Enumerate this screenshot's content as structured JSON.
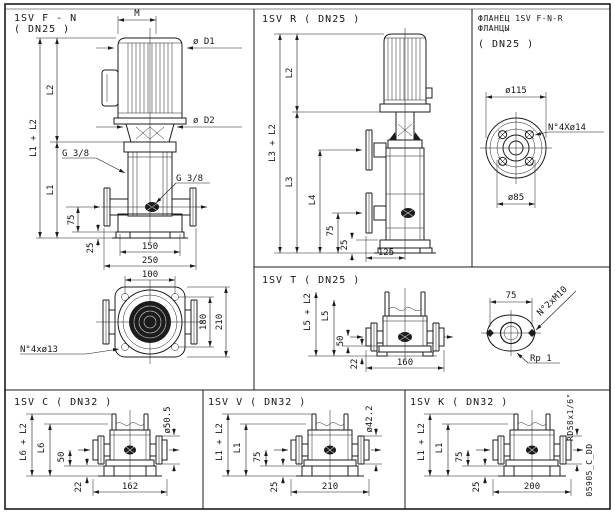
{
  "drawing_code": "05905_C_DD",
  "panels": {
    "fn": {
      "title1": "1SV F - N",
      "title2": "( DN25 )",
      "m": "M",
      "d1": "ø D1",
      "d2": "ø D2",
      "l2": "L2",
      "l1_l2": "L1 + L2",
      "l1": "L1",
      "g38_left": "G 3/8",
      "g38_right": "G 3/8",
      "d75": "75",
      "d25": "25",
      "d150": "150",
      "d250": "250",
      "bottom_view": {
        "d100": "100",
        "d180": "180",
        "d210": "210",
        "holes": "N°4xø13"
      }
    },
    "r": {
      "title": "1SV R ( DN25 )",
      "l2": "L2",
      "l3_l2": "L3 + L2",
      "l3": "L3",
      "l4": "L4",
      "d75": "75",
      "d25": "25",
      "d125": "125"
    },
    "flange_fnr": {
      "line1": "ФЛАНЕЦ 1SV F-N-R",
      "line2": "ФЛАНЦЫ",
      "line3": "( DN25 )",
      "d115": "ø115",
      "holes": "N°4Xø14",
      "d85": "ø85"
    },
    "t": {
      "title": "1SV T ( DN25 )",
      "l5_l2": "L5 + L2",
      "l5": "L5",
      "d50": "50",
      "d22": "22",
      "d160": "160",
      "oval_d75": "75",
      "oval_holes": "N°2xM10",
      "oval_thread": "Rp 1"
    },
    "c": {
      "title": "1SV C ( DN32 )",
      "l6_l2": "L6 + L2",
      "l6": "L6",
      "d50": "50",
      "d22": "22",
      "d162": "162",
      "od": "ø50.5"
    },
    "v": {
      "title": "1SV V ( DN32 )",
      "l1_l2": "L1 + L2",
      "l1": "L1",
      "d75": "75",
      "d25": "25",
      "d210": "210",
      "od": "ø42.2"
    },
    "k": {
      "title": "1SV K ( DN32 )",
      "l1_l2": "L1 + L2",
      "l1": "L1",
      "d75": "75",
      "d25": "25",
      "d200": "200",
      "thread": "RD58x1/6\""
    }
  }
}
